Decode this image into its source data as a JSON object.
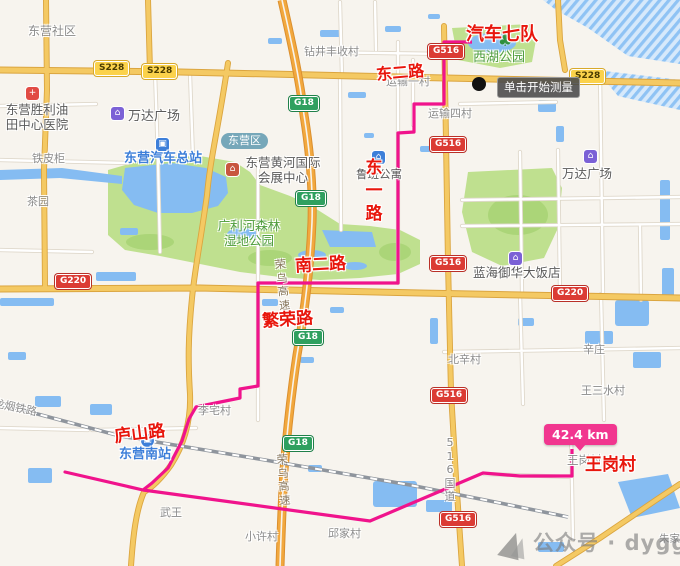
{
  "measure_tool": {
    "tooltip": "单击开始测量",
    "distance_label": "42.4 km"
  },
  "watermark": {
    "text": "公众号 · dyggjt"
  },
  "route": {
    "color": "#F0138C",
    "labels": [
      {
        "text": "汽车七队"
      },
      {
        "text": "东二路"
      },
      {
        "text": "东一路"
      },
      {
        "text": "南二路"
      },
      {
        "text": "繁荣路"
      },
      {
        "text": "庐山路"
      },
      {
        "text": "王岗村"
      }
    ]
  },
  "road_badges": {
    "s228": "S228",
    "g516": "G516",
    "g220": "G220",
    "g18": "G18"
  },
  "district_badge": {
    "label": "东营区"
  },
  "road_names": {
    "rongwu_expressway": "荣乌高速",
    "g516_national_road": "516国道",
    "railway": "龙烟铁路"
  },
  "icons": {
    "hospital": "+",
    "tree": "♣",
    "mall": "⌂",
    "bus": "▣",
    "expo": "⌂",
    "apartment": "⌂",
    "hotel": "⌂",
    "train": "▣"
  },
  "colors": {
    "route": "#F0138C",
    "annotation_red": "#E8160C",
    "badge_national_bg": "#DB3B34",
    "badge_provincial_bg": "#FBD24B",
    "badge_expressway_bg": "#2FA05F",
    "district_badge_bg": "#6AA0B4",
    "poi_blue": "#3D7FD9",
    "poi_green": "#4E9C3C",
    "water": "#85BCF2",
    "park": "#BFE08F"
  },
  "pois": [
    {
      "name": "东营社区"
    },
    {
      "name": "钻井丰收村"
    },
    {
      "name": "运输一村"
    },
    {
      "name": "运输四村"
    },
    {
      "name": "西湖公园"
    },
    {
      "name": "万达广场"
    },
    {
      "name": "东营胜利油田中心医院"
    },
    {
      "name": "东营汽车总站"
    },
    {
      "name": "铁皮柜"
    },
    {
      "name": "茶园"
    },
    {
      "name": "东营黄河国际会展中心"
    },
    {
      "name": "广利河森林湿地公园"
    },
    {
      "name": "鲁班公寓"
    },
    {
      "name": "蓝海御华大饭店"
    },
    {
      "name": "万达广场"
    },
    {
      "name": "辛庄"
    },
    {
      "name": "北辛村"
    },
    {
      "name": "王三水村"
    },
    {
      "name": "李宅村"
    },
    {
      "name": "东营南站"
    },
    {
      "name": "武王"
    },
    {
      "name": "小许村"
    },
    {
      "name": "邱家村"
    },
    {
      "name": "朱家村"
    },
    {
      "name": "王岗村"
    }
  ]
}
